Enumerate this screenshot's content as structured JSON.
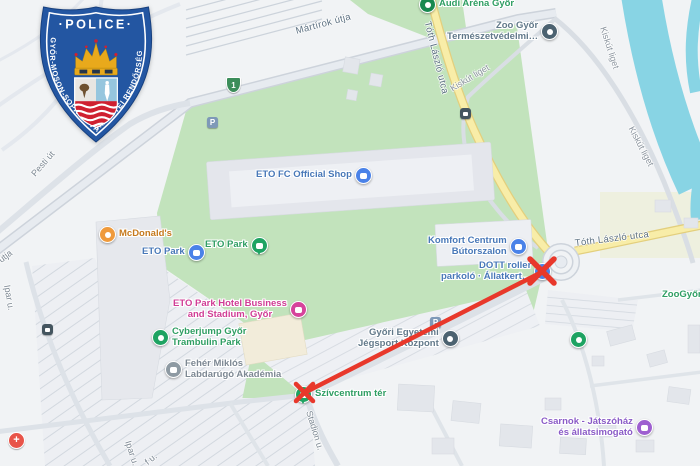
{
  "badge": {
    "title": "·POLICE·",
    "ring": "GYŐR-MOSON-SOPRON VÁRMEGYEI RENDŐRSÉG"
  },
  "streets": {
    "martirok": "Mártírok útja",
    "martirok_partial": "k útja",
    "toth_v": "Tóth László utca",
    "toth_h": "Tóth László utca",
    "kiskut_1": "Kiskút liget",
    "kiskut_2": "Kiskút liget",
    "kiskut_3": "Kiskút liget",
    "pesti": "Pesti út",
    "ipar_1": "Ipar u.",
    "ipar_2": "Ipar u.",
    "stadion": "Stadion u.",
    "partial_f": "f u."
  },
  "pois": {
    "audi_arena": {
      "label": "Audi Aréna Győr"
    },
    "zoo_gyor": {
      "label": "Zoo Győr\nTermészetvédelmi…"
    },
    "eto_fc_shop": {
      "label": "ETO FC Official Shop"
    },
    "mcdonalds": {
      "label": "McDonald's"
    },
    "eto_park_mall": {
      "label": "ETO Park"
    },
    "eto_park_green": {
      "label": "ETO Park"
    },
    "eto_park_hotel": {
      "label": "ETO Park Hotel Business\nand Stadium, Győr"
    },
    "komfort": {
      "label": "Komfort Centrum\nBútorszalon"
    },
    "dott": {
      "label": "DOTT roller\nparkoló · Állatkert…"
    },
    "jegsport": {
      "label": "Győri Egyetemi\nJégsport Központ"
    },
    "cyberjump": {
      "label": "Cyberjump Győr\nTrambulin Park"
    },
    "feher_miklos": {
      "label": "Fehér Miklós\nLabdarúgó Akadémia"
    },
    "szivcentrum": {
      "label": "Szívcentrum tér"
    },
    "csarnok": {
      "label": "Csarnok - Játszóház\nés állatsimogató"
    },
    "zoogyor_edge": {
      "label": "ZooGyőr"
    }
  },
  "markers": {
    "parking": "P",
    "route_number": "1",
    "health_cross": "+"
  },
  "colors": {
    "route_red": "#e8382b",
    "park_green": "#c2e3bc",
    "water_blue": "#88d4e4",
    "road_yellow": "#f8eda8",
    "poi_blue": "#4878b8",
    "poi_green": "#2f9e63",
    "poi_pink": "#d03d95",
    "poi_purple": "#8a5bc7",
    "poi_orange": "#c67a1e",
    "poi_slate": "#62798a",
    "badge_blue": "#2356a2"
  }
}
